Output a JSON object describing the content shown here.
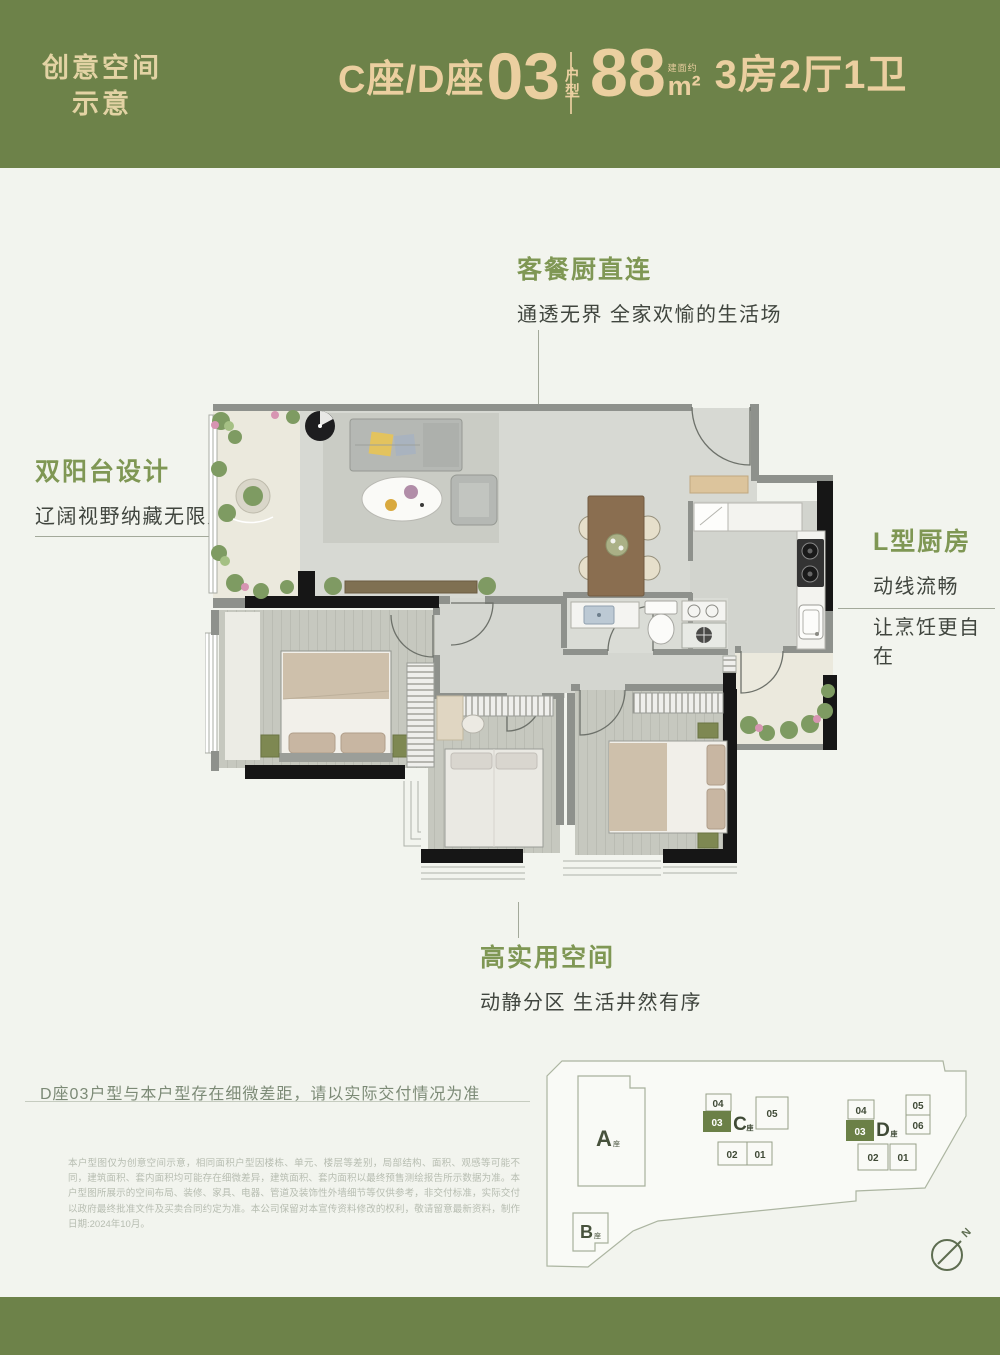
{
  "colors": {
    "band_green": "#6d8249",
    "accent_cream": "#ebcfa0",
    "title_green": "#7f9754",
    "body_dark": "#40453e",
    "note_green": "#7c8a76",
    "fine_print_gray": "#b7bdb1",
    "page_bg": "#f2f4ee",
    "highlight_unit_green": "#6b8047"
  },
  "header": {
    "watermark_line1": "创意空间",
    "watermark_line2": "示意",
    "unit_prefix": "C座/D座",
    "unit_number": "03",
    "unit_suffix_top": "户",
    "unit_suffix_bottom": "型",
    "area_number": "88",
    "area_note": "建面约",
    "area_unit": "m²",
    "layout_spec": "3房2厅1卫"
  },
  "annotations": {
    "dining": {
      "title": "客餐厨直连",
      "subtitle": "通透无界 全家欢愉的生活场"
    },
    "balcony": {
      "title": "双阳台设计",
      "subtitle": "辽阔视野纳藏无限风光"
    },
    "kitchen": {
      "title": "L型厨房",
      "line1": "动线流畅",
      "line2": "让烹饪更自在"
    },
    "space": {
      "title": "高实用空间",
      "subtitle": "动静分区 生活井然有序"
    }
  },
  "note": "D座03户型与本户型存在细微差距，请以实际交付情况为准",
  "disclaimer": "本户型图仅为创意空间示意，相同面积户型因楼栋、单元、楼层等差别，局部结构、面积、观感等可能不同，建筑面积、套内面积均可能存在细微差异，建筑面积、套内面积以最终预售测绘报告所示数据为准。本户型图所展示的空间布局、装修、家具、电器、管道及装饰性外墙细节等仅供参考，非交付标准，实际交付以政府最终批准文件及买卖合同约定为准。本公司保留对本宣传资料修改的权利，敬请留意最新资料，制作日期:2024年10月。",
  "siteplan": {
    "building_a": "A",
    "building_b": "B",
    "building_c": "C",
    "building_d": "D",
    "building_suffix": "座",
    "c_units": [
      "04",
      "03",
      "05",
      "02",
      "01"
    ],
    "d_units": [
      "04",
      "03",
      "05",
      "06",
      "02",
      "01"
    ],
    "compass_label": "N"
  }
}
